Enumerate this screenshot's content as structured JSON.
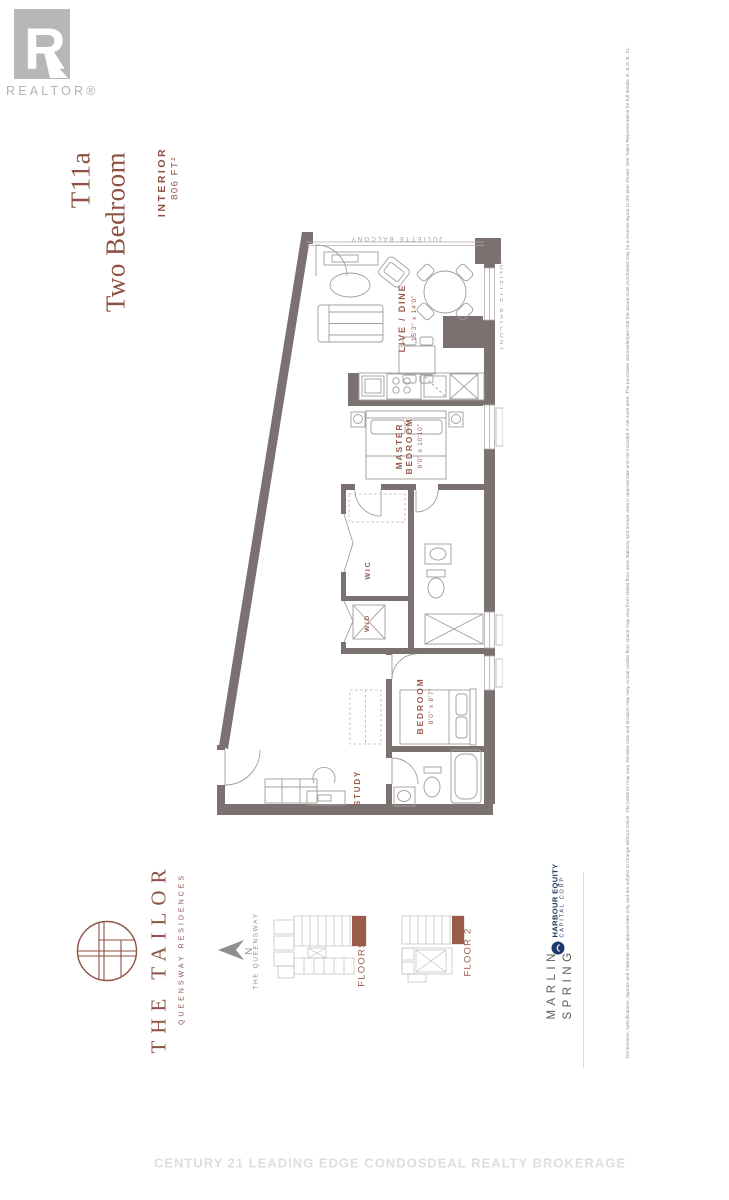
{
  "branding": {
    "realtor_logo_text": "REALTOR®",
    "project_name": "THE TAILOR",
    "project_subtitle": "QUEENSWAY RESIDENCES"
  },
  "title": {
    "unit": "T11a",
    "type": "Two Bedroom",
    "interior_label": "INTERIOR",
    "interior_area": "806 FT²"
  },
  "floorplan": {
    "juliette_top": "JULIETTE BALCONY",
    "juliette_right": "JULIETTE BALCONY",
    "rooms": {
      "live_dine": {
        "label": "LIVE / DINE",
        "dims": "15'3\" x 14'0\""
      },
      "master": {
        "line1": "MASTER",
        "line2": "BEDROOM",
        "dims": "9'0\" x 10'10\""
      },
      "wic": "WIC",
      "wd": "W/D",
      "bedroom": {
        "label": "BEDROOM",
        "dims": "8'0\" x 8'7\""
      },
      "study": "STUDY"
    }
  },
  "keyplans": {
    "street": "THE QUEENSWAY",
    "north": "N",
    "plan1": "FLOORS 3-6",
    "plan2": "FLOOR 2"
  },
  "developers": {
    "marlin_line1": "MARLIN",
    "marlin_line2": "SPRING",
    "harbour_line1": "HARBOUR EQUITY",
    "harbour_line2": "CAPITAL CORP"
  },
  "disclaimer": "Dimensions, specifications, layouts and materials are approximate only and are subject to change without notice. Tile patterns may vary. Window size and location may vary. Actual usable floor space may vary from stated floor area. Balcony and terrace area is approximate and not included in net suite area. The purchaser acknowledges that the actual suite purchased may be a reverse layout to the plan shown. See Sales Representative for full details. E. & O. E. 21.",
  "watermark": "CENTURY 21 LEADING EDGE CONDOSDEAL REALTY BROKERAGE",
  "colors": {
    "accent": "#8d5243",
    "wall": "#7c7171",
    "logo_grey": "#b7b7b7",
    "navy": "#1b3a6b"
  }
}
